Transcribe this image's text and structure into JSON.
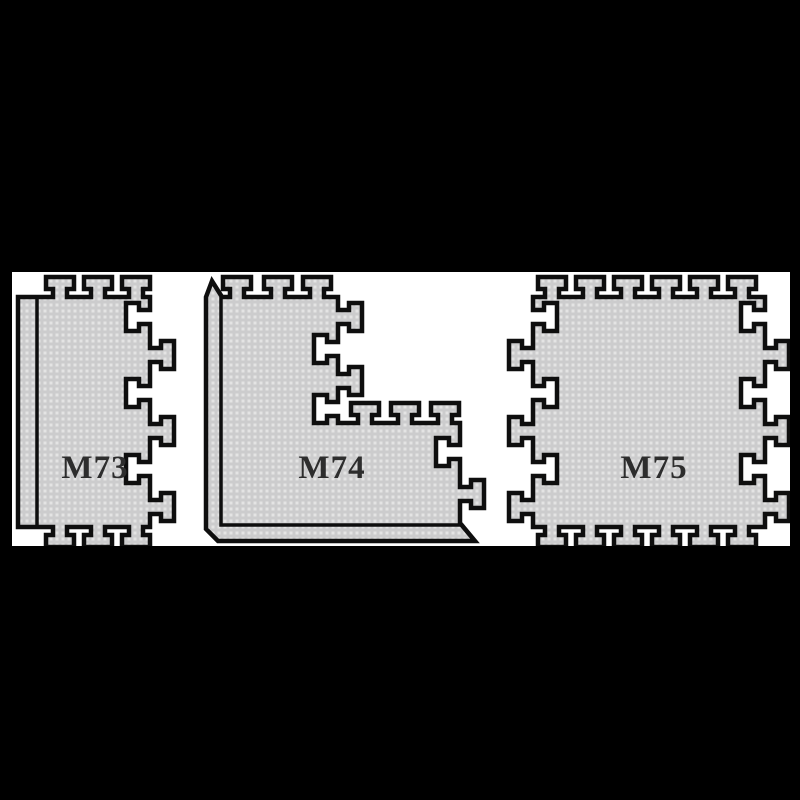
{
  "scene": {
    "background_color": "#000000",
    "panel_color": "#ffffff"
  },
  "colors": {
    "mat_fill": "#cccccd",
    "mat_dot": "#e4e4e4",
    "outline": "#0e0e0e",
    "label": "#2d2d2d"
  },
  "mats": [
    {
      "id": "m73",
      "label": "M73"
    },
    {
      "id": "m74",
      "label": "M74"
    },
    {
      "id": "m75",
      "label": "M75"
    }
  ]
}
